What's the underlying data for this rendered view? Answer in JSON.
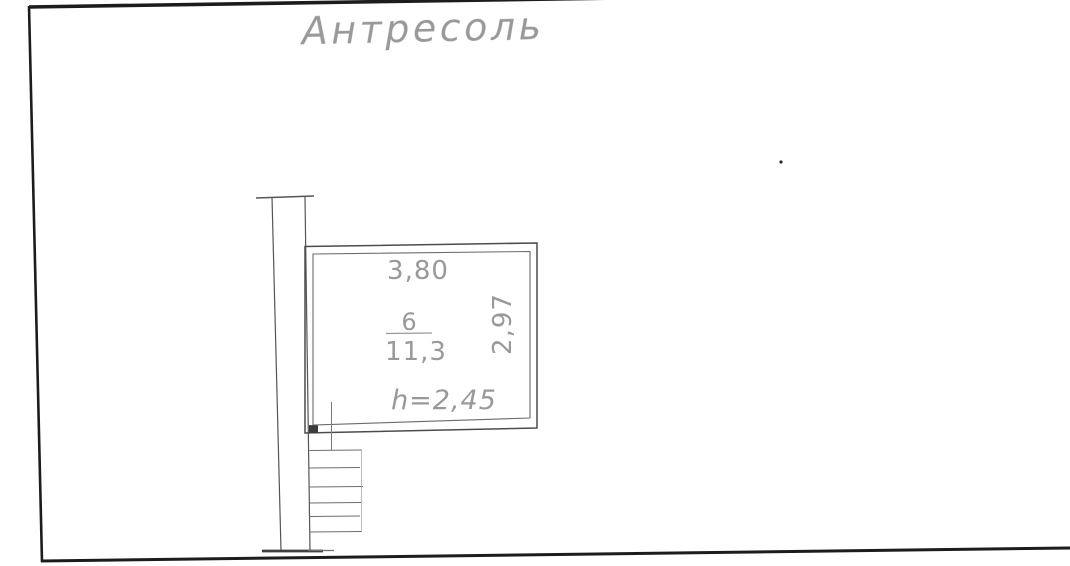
{
  "title": "Антресоль",
  "room": {
    "number": "6",
    "area": "11,3",
    "width_dim": "3,80",
    "depth_dim": "2,97",
    "ceiling_height": "h=2,45"
  },
  "colors": {
    "paper": "#ffffff",
    "frame": "#1c1c1c",
    "wall_line": "#555555",
    "room_line": "#4c4c4c",
    "thin_line": "#6e6e6e",
    "text": "#8b8b8b"
  }
}
